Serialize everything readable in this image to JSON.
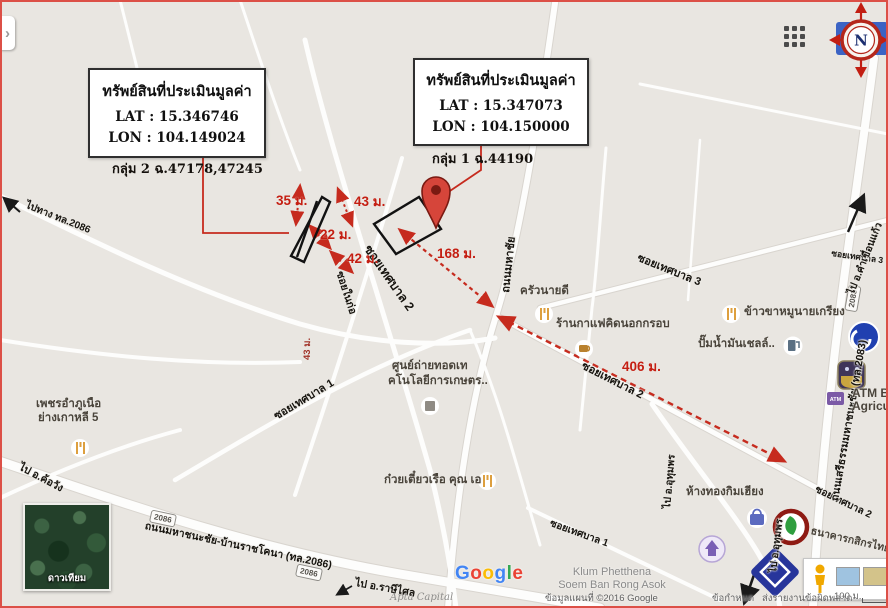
{
  "callout1": {
    "title": "ทรัพย์สินที่ประเมินมูลค่า",
    "lat": "LAT : 15.346746",
    "lon": "LON : 104.149024",
    "caption": "กลุ่ม 2 ฉ.47178,47245"
  },
  "callout2": {
    "title": "ทรัพย์สินที่ประเมินมูลค่า",
    "lat": "LAT : 15.347073",
    "lon": "LON : 104.150000",
    "caption": "กลุ่ม 1 ฉ.44190"
  },
  "measurements": {
    "m35": "35 ม.",
    "m43": "43 ม.",
    "m22": "22 ม.",
    "m42": "42 ม.",
    "m168": "168 ม.",
    "m406": "406 ม.",
    "m43side": "43 ม."
  },
  "streets": {
    "t2_big": "ซอยเทศบาล 2",
    "t2_mid": "ซอยเทศบาล 2",
    "t2_right": "ซอยเทศบาล 2",
    "t3": "ซอยเทศบาล 3",
    "t3_right": "ซอยเทศบาล 3",
    "t1": "ซอยเทศบาล 1",
    "t1_bottom": "ซอยเทศบาล 1",
    "naikor": "ซอยในก่อ",
    "mahachai": "ถนนมหาชัย",
    "hwy2083": "ถนนเสรีธรรมมหาชนะชัย (ทล.2083)",
    "hwy2086": "ถนนมหาชนะชัย-บ้านราชโคนา (ทล.2086)",
    "to2086": "ไปทาง ทล.2086",
    "to_rasi": "ไป อ.ราษีไศล",
    "to_khowang": "ไป อ.ค้อวัง",
    "to_kham": "ไป อ.คำเขื่อนแก้ว",
    "to_uthum_a": "ไป อ.อุทุมพร",
    "to_uthum_b": "ไป อ.อุทุมพร"
  },
  "shields": {
    "s2086a": "2086",
    "s2086b": "2086",
    "s2083": "2083"
  },
  "pois": {
    "krua": "ครัวนายดี",
    "coffee": "ร้านกาแฟคิดนอกกรอบ",
    "khao": "ข้าวขาหมูนายเกรียง",
    "shell": "ปั๊มน้ำมันเชลล์..",
    "atm1": "ATM B",
    "atm2": "Agricul",
    "atm_badge": "ATM",
    "noodle": "ก๋วยเตี๋ยวเรือ คุณ เอ",
    "korean1": "เพชรอำภูเนือ",
    "korean2": "ย่างเกาหลี 5",
    "agri1": "ศูนย์ถ่ายทอดเท",
    "agri2": "คโนโลยีการเกษตร..",
    "goldshop": "ห้างทองกิมเฮียง",
    "kbank": "ธนาคารกสิกรไทย"
  },
  "controls": {
    "compass_n": "N",
    "satellite": "ดาวเทียม",
    "chevron": "›"
  },
  "footer": {
    "google": [
      "G",
      "o",
      "o",
      "g",
      "l",
      "e"
    ],
    "place1": "Klum Phetthena",
    "place2": "Soem Ban Rong Asok",
    "mapdata": "ข้อมูลแผนที่ ©2016 Google",
    "terms": "ข้อกำหนด",
    "report": "ส่งรายงานข้อผิดพลาด",
    "scale": "100 ม.",
    "watermark": "Apta Capital"
  },
  "colors": {
    "accent_red": "#c62b1e",
    "map_bg": "#e9e6e1",
    "compass_blue": "#3b63c4",
    "frame_red": "#dc5047"
  }
}
